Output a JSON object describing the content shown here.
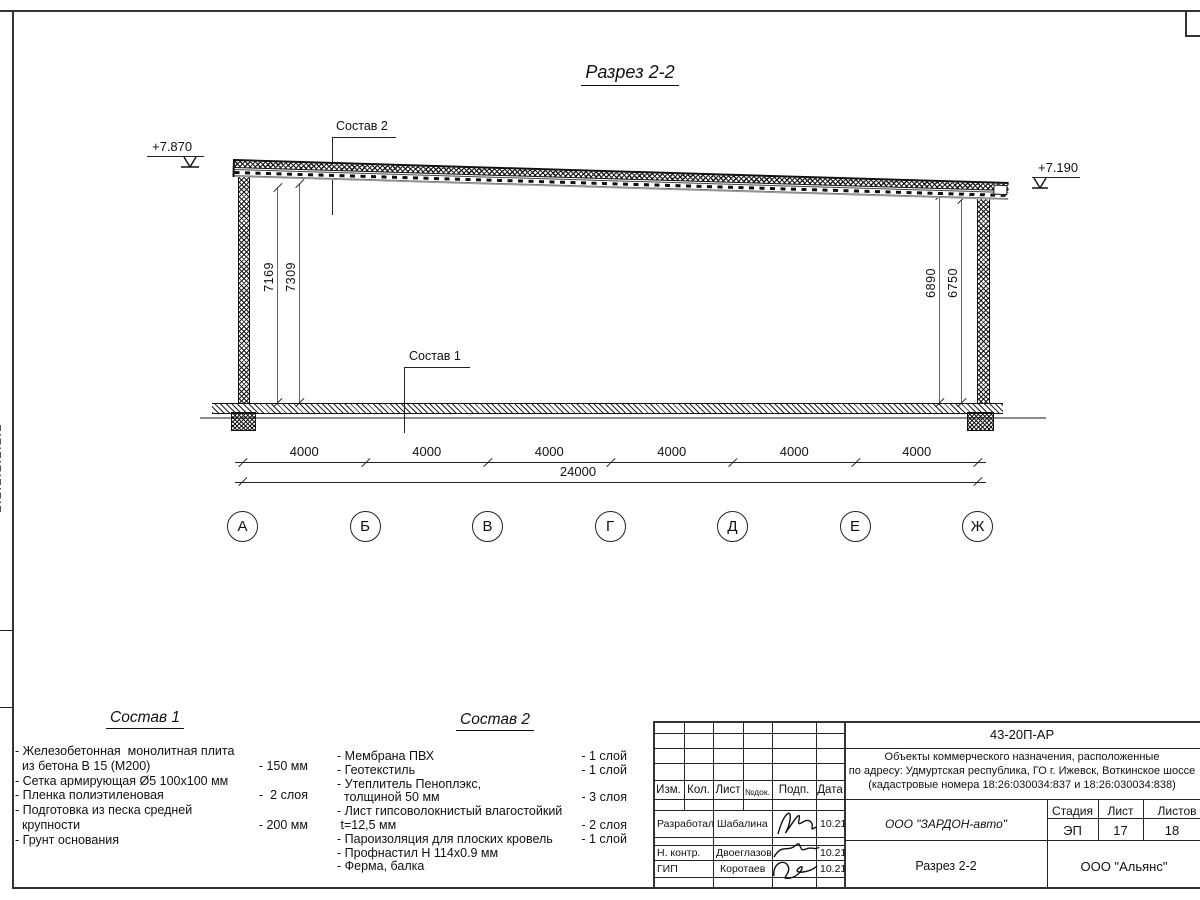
{
  "sheet": {
    "title": "Разрез 2-2",
    "elevations": {
      "left": "+7.870",
      "right": "+7.190"
    },
    "callouts": {
      "sostav1": "Состав 1",
      "sostav2": "Состав 2"
    },
    "dims": {
      "left": [
        "7169",
        "7309"
      ],
      "right": [
        "6890",
        "6750"
      ],
      "bays": [
        "4000",
        "4000",
        "4000",
        "4000",
        "4000",
        "4000"
      ],
      "total": "24000"
    },
    "axes": [
      "А",
      "Б",
      "В",
      "Г",
      "Д",
      "Е",
      "Ж"
    ]
  },
  "spec1": {
    "heading": "Состав 1",
    "rows": [
      {
        "label": "- Железобетонная  монолитная плита",
        "value": ""
      },
      {
        "label": "  из бетона В 15 (М200)",
        "value": "- 150 мм"
      },
      {
        "label": "- Сетка армирующая Ø5 100х100 мм",
        "value": ""
      },
      {
        "label": "- Пленка полиэтиленовая",
        "value": "-  2 слоя"
      },
      {
        "label": "- Подготовка из песка средней",
        "value": ""
      },
      {
        "label": "  крупности",
        "value": "- 200 мм"
      },
      {
        "label": "- Грунт основания",
        "value": ""
      }
    ]
  },
  "spec2": {
    "heading": "Состав 2",
    "rows": [
      {
        "label": "- Мембрана ПВХ",
        "value": "- 1 слой"
      },
      {
        "label": "- Геотекстиль",
        "value": "- 1 слой"
      },
      {
        "label": "- Утеплитель Пеноплэкс,",
        "value": ""
      },
      {
        "label": "  толщиной 50 мм",
        "value": "- 3 слоя"
      },
      {
        "label": "- Лист гипсоволокнистый влагостойкий",
        "value": ""
      },
      {
        "label": " t=12,5 мм",
        "value": "- 2 слоя"
      },
      {
        "label": "- Пароизоляция для плоских кровель",
        "value": "- 1 слой"
      },
      {
        "label": "- Профнастил Н 114х0.9 мм",
        "value": ""
      },
      {
        "label": "- Ферма, балка",
        "value": ""
      }
    ]
  },
  "titleblock": {
    "doc_number": "43-20П-АР",
    "desc": [
      "Объекты коммерческого назначения, расположенные",
      "по адресу: Удмуртская республика, ГО г. Ижевск, Воткинское шоссе",
      "(кадастровые номера 18:26:030034:837 и 18:26:030034:838)"
    ],
    "header": [
      "Изм.",
      "Кол.",
      "Лист",
      "№док.",
      "Подп.",
      "Дата"
    ],
    "sign_rows": [
      {
        "role": "Разработал",
        "name": "Шабалина",
        "date": "10.21"
      },
      {
        "role": "Н. контр.",
        "name": "Двоеглазов",
        "date": "10.21"
      },
      {
        "role": "ГИП",
        "name": "Коротаев",
        "date": "10.21"
      }
    ],
    "company": "ООО \"ЗАРДОН-авто\"",
    "sheet_title": "Разрез 2-2",
    "org": "ООО \"Альянс\"",
    "stage_label": "Стадия",
    "sheet_label": "Лист",
    "sheets_label": "Листов",
    "stage": "ЭП",
    "sheet_no": "17",
    "sheets_total": "18"
  }
}
